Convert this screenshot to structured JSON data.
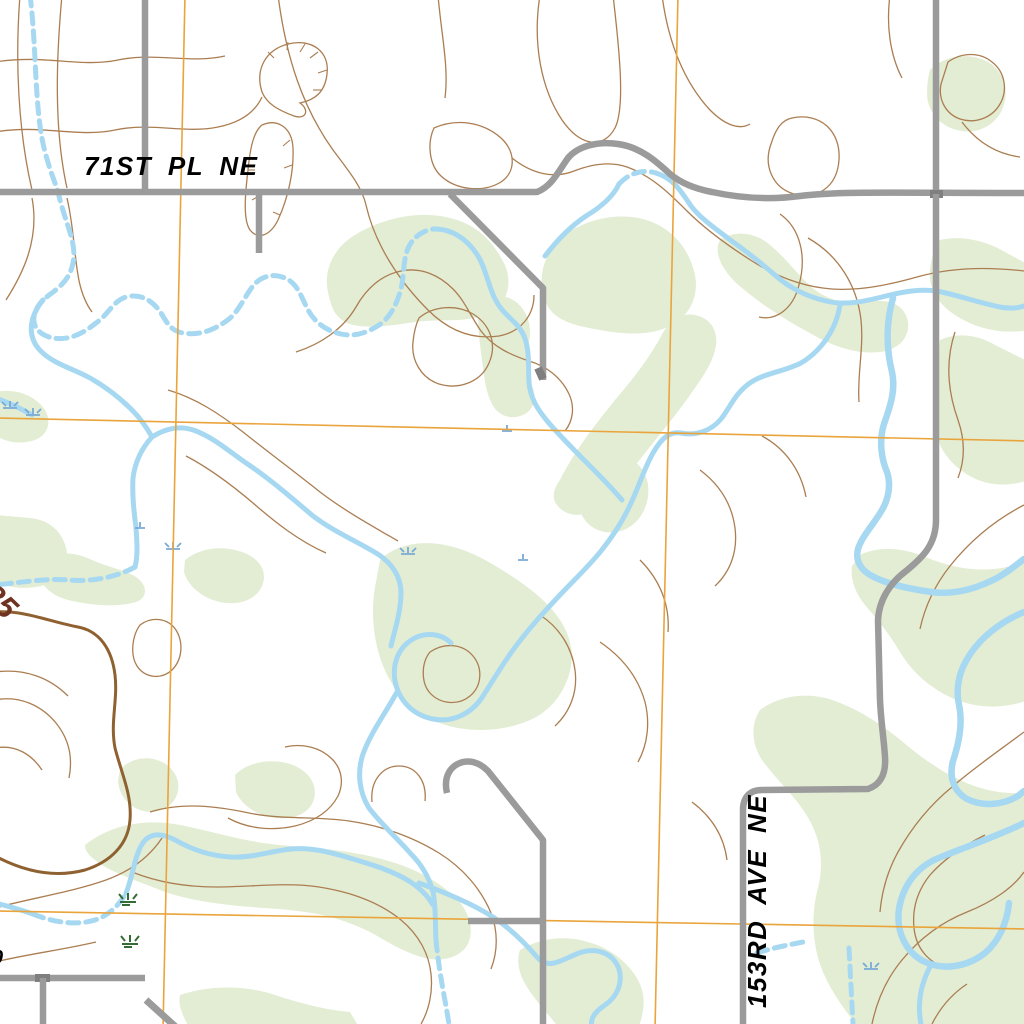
{
  "labels": {
    "road_71st_pl_ne": "71ST PL NE",
    "road_153rd_ave_ne": "153RD AVE NE",
    "contour_elevation_825": "825",
    "clipped_label_0": "0"
  },
  "colors": {
    "background": "#ffffff",
    "vegetation": "#e3edd4",
    "contour": "#ab7e52",
    "index_contour": "#8f6130",
    "contour_label": "#6f3322",
    "stream": "#a7d8f1",
    "marsh_blue": "#79aad6",
    "marsh_green": "#356b35",
    "road": "#9b9b9b",
    "road_junction": "#7f7f7f",
    "section_line": "#eaa43c",
    "road_label": "#000000"
  },
  "icons": {
    "marsh_blue": "wetland-tuft-icon",
    "marsh_green": "wetland-tuft-icon",
    "depression_hachures": "depression-contour-ticks"
  },
  "map_features": {
    "grid": "orange section lines, 2 vertical + 2 horizontal, slightly tilted",
    "streams": "light blue meandering, partly dashed (intermittent)",
    "roads": "gray unimproved roads",
    "terrain": "brown contour lines with one thick index contour labeled 825"
  }
}
